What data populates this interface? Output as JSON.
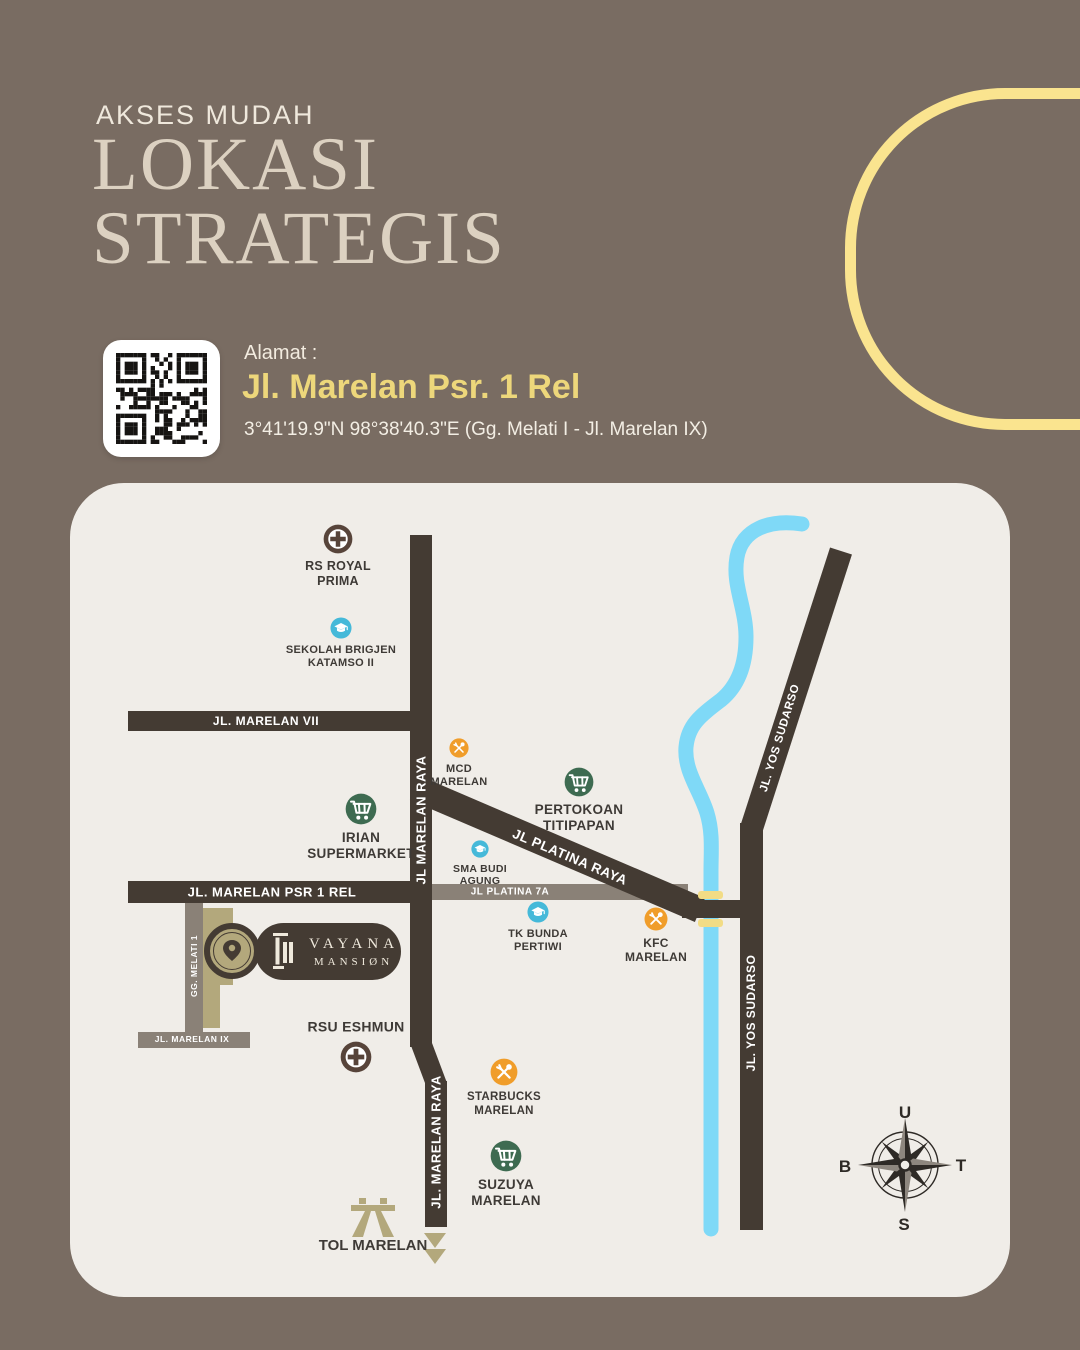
{
  "header": {
    "kicker": "AKSES MUDAH",
    "title_line1": "LOKASI",
    "title_line2": "STRATEGIS"
  },
  "address": {
    "label": "Alamat :",
    "street": "Jl. Marelan Psr. 1 Rel",
    "coordinates": "3°41'19.9\"N 98°38'40.3\"E  (Gg. Melati I - Jl. Marelan IX)"
  },
  "map": {
    "road_labels": [
      {
        "id": "marelan-vii",
        "text": "JL. MARELAN VII"
      },
      {
        "id": "marelan-psr-1-rel",
        "text": "JL. MARELAN PSR 1 REL"
      },
      {
        "id": "platina-7a",
        "text": "JL PLATINA 7A"
      },
      {
        "id": "platina-raya",
        "text": "JL PLATINA RAYA"
      },
      {
        "id": "marelan-raya-upper",
        "text": "JL MARELAN RAYA"
      },
      {
        "id": "marelan-raya-lower",
        "text": "JL. MARELAN RAYA"
      },
      {
        "id": "yos-sudarso-diagonal",
        "text": "JL. YOS SUDARSO"
      },
      {
        "id": "yos-sudarso-lower",
        "text": "JL. YOS SUDARSO"
      },
      {
        "id": "gg-melati-1",
        "text": "GG. MELATI 1"
      },
      {
        "id": "marelan-ix",
        "text": "JL. MARELAN IX"
      }
    ],
    "pois": [
      {
        "id": "rs-royal-prima",
        "type": "hospital",
        "lines": [
          "RS ROYAL",
          "PRIMA"
        ]
      },
      {
        "id": "sekolah-brigjen-katamso-ii",
        "type": "school",
        "lines": [
          "SEKOLAH BRIGJEN",
          "KATAMSO II"
        ]
      },
      {
        "id": "mcd-marelan",
        "type": "restaurant",
        "lines": [
          "MCD",
          "MARELAN"
        ]
      },
      {
        "id": "irian-supermarket",
        "type": "market",
        "lines": [
          "IRIAN",
          "SUPERMARKET"
        ]
      },
      {
        "id": "pertokoan-titipapan",
        "type": "market",
        "lines": [
          "PERTOKOAN",
          "TITIPAPAN"
        ]
      },
      {
        "id": "sma-budi-agung",
        "type": "school",
        "lines": [
          "SMA BUDI",
          "AGUNG"
        ]
      },
      {
        "id": "tk-bunda-pertiwi",
        "type": "school",
        "lines": [
          "TK BUNDA",
          "PERTIWI"
        ]
      },
      {
        "id": "kfc-marelan",
        "type": "restaurant",
        "lines": [
          "KFC",
          "MARELAN"
        ]
      },
      {
        "id": "rsu-eshmun",
        "type": "hospital",
        "lines": [
          "RSU ESHMUN"
        ]
      },
      {
        "id": "starbucks-marelan",
        "type": "restaurant",
        "lines": [
          "STARBUCKS",
          "MARELAN"
        ]
      },
      {
        "id": "suzuya-marelan",
        "type": "market",
        "lines": [
          "SUZUYA",
          "MARELAN"
        ]
      }
    ],
    "landmark": {
      "name_line1": "VAYANA",
      "name_line2": "MANSIØN"
    },
    "tol": {
      "label": "TOL MARELAN"
    },
    "compass": {
      "north": "U",
      "east": "T",
      "south": "S",
      "west": "B"
    }
  },
  "colors": {
    "background": "#796C62",
    "title_cream": "#DCD1C1",
    "accent_yellow": "#EDD77B",
    "arc_yellow": "#FAE48F",
    "map_bg": "#F0EDE8",
    "road_dark": "#443B33",
    "road_gray": "#8A8177",
    "river_blue": "#7FD9F7",
    "poi_orange": "#F09D2A",
    "poi_green": "#3E6B51",
    "poi_blue": "#45B9D9",
    "poi_hospital": "#57443A",
    "khaki": "#B3A87C",
    "bridge_yellow": "#F2DC85",
    "label_dark": "#3E3A36"
  }
}
